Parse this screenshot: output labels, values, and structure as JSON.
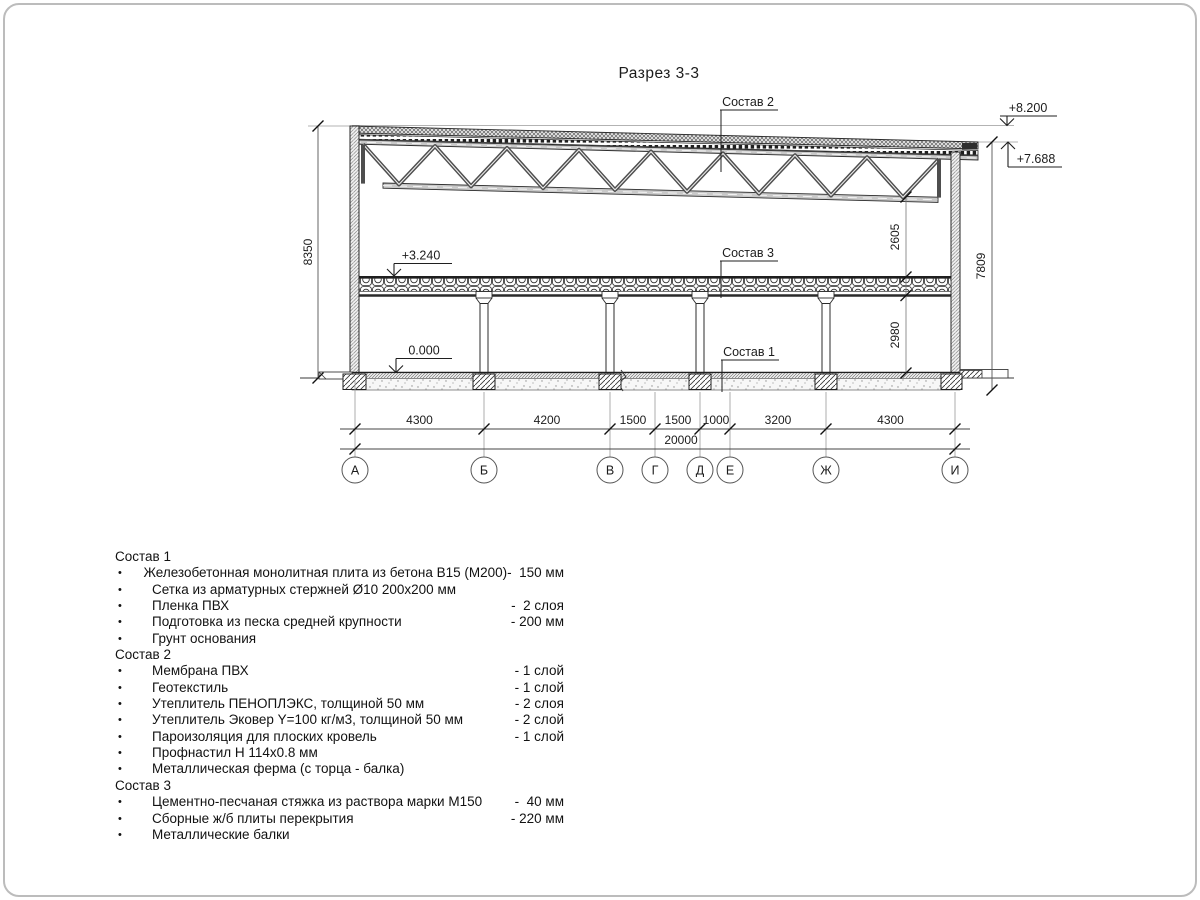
{
  "title": "Разрез 3-3",
  "elevations": {
    "roof_high": "+8.200",
    "roof_low": "+7.688",
    "floor2": "+3.240",
    "ground": "0.000"
  },
  "callouts": {
    "c1": "Состав 1",
    "c2": "Состав 2",
    "c3": "Состав 3"
  },
  "dims": {
    "left_height": "8350",
    "right_height": "7809",
    "truss_to_floor": "2605",
    "floor_clear": "2980",
    "total": "20000",
    "spans": [
      "4300",
      "4200",
      "1500",
      "1500",
      "1000",
      "3200",
      "4300"
    ]
  },
  "axes": [
    "А",
    "Б",
    "В",
    "Г",
    "Д",
    "Е",
    "Ж",
    "И"
  ],
  "legend": {
    "sections": [
      {
        "title": "Состав 1",
        "bullet": "•",
        "items": [
          {
            "name": "Железобетонная монолитная плита из бетона В15 (М200)",
            "value": "-  150 мм"
          },
          {
            "name": "Сетка из арматурных стержней Ø10 200x200 мм",
            "value": ""
          },
          {
            "name": "Пленка ПВХ",
            "value": "-  2 слоя"
          },
          {
            "name": "Подготовка из песка средней крупности",
            "value": "- 200 мм"
          },
          {
            "name": "Грунт основания",
            "value": ""
          }
        ]
      },
      {
        "title": "Состав 2",
        "bullet": "•",
        "items": [
          {
            "name": "Мембрана ПВХ",
            "value": "- 1 слой"
          },
          {
            "name": "Геотекстиль",
            "value": "- 1 слой"
          },
          {
            "name": "Утеплитель ПЕНОПЛЭКС, толщиной 50 мм",
            "value": "- 2 слоя"
          },
          {
            "name": "Утеплитель Эковер Y=100 кг/м3, толщиной 50 мм",
            "value": "- 2 слой"
          },
          {
            "name": "Пароизоляция для плоских кровель",
            "value": "- 1 слой"
          },
          {
            "name": "Профнастил Н 114х0.8 мм",
            "value": ""
          },
          {
            "name": "Металлическая ферма (с торца - балка)",
            "value": ""
          }
        ]
      },
      {
        "title": "Состав 3",
        "bullet": "•",
        "items": [
          {
            "name": "Цементно-песчаная стяжка из раствора марки М150",
            "value": "-  40 мм"
          },
          {
            "name": "Сборные ж/б плиты перекрытия",
            "value": "- 220 мм"
          },
          {
            "name": "Металлические балки",
            "value": ""
          }
        ]
      }
    ]
  }
}
